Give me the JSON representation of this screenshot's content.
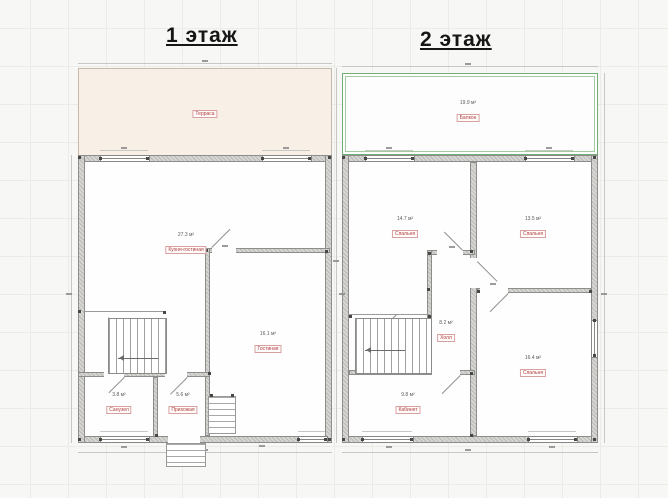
{
  "titles": {
    "floor1": "1 этаж",
    "floor2": "2 этаж"
  },
  "floor1": {
    "terrace": {
      "label": "Терраса"
    },
    "rooms": [
      {
        "name": "Кухня-гостиная",
        "area": "27.3 м²"
      },
      {
        "name": "Гостиная",
        "area": "16.1 м²"
      },
      {
        "name": "Санузел",
        "area": "3.8 м²"
      },
      {
        "name": "Прихожая",
        "area": "5.6 м²"
      }
    ]
  },
  "floor2": {
    "balcony": {
      "name": "Балкон",
      "area": "19.9 м²"
    },
    "rooms": [
      {
        "name": "Спальня",
        "area": "14.7 м²"
      },
      {
        "name": "Спальня",
        "area": "13.5 м²"
      },
      {
        "name": "Спальня",
        "area": "16.4 м²"
      },
      {
        "name": "Кабинет",
        "area": "9.8 м²"
      },
      {
        "name": "Холл",
        "area": "8.2 м²"
      }
    ]
  },
  "colors": {
    "terrace_fill": "#f8f0e6",
    "balcony_border": "#74ad74",
    "wall_fill": "#d7d6d3",
    "label_accent": "#b23a3a",
    "grid_line": "#ebebe8"
  }
}
